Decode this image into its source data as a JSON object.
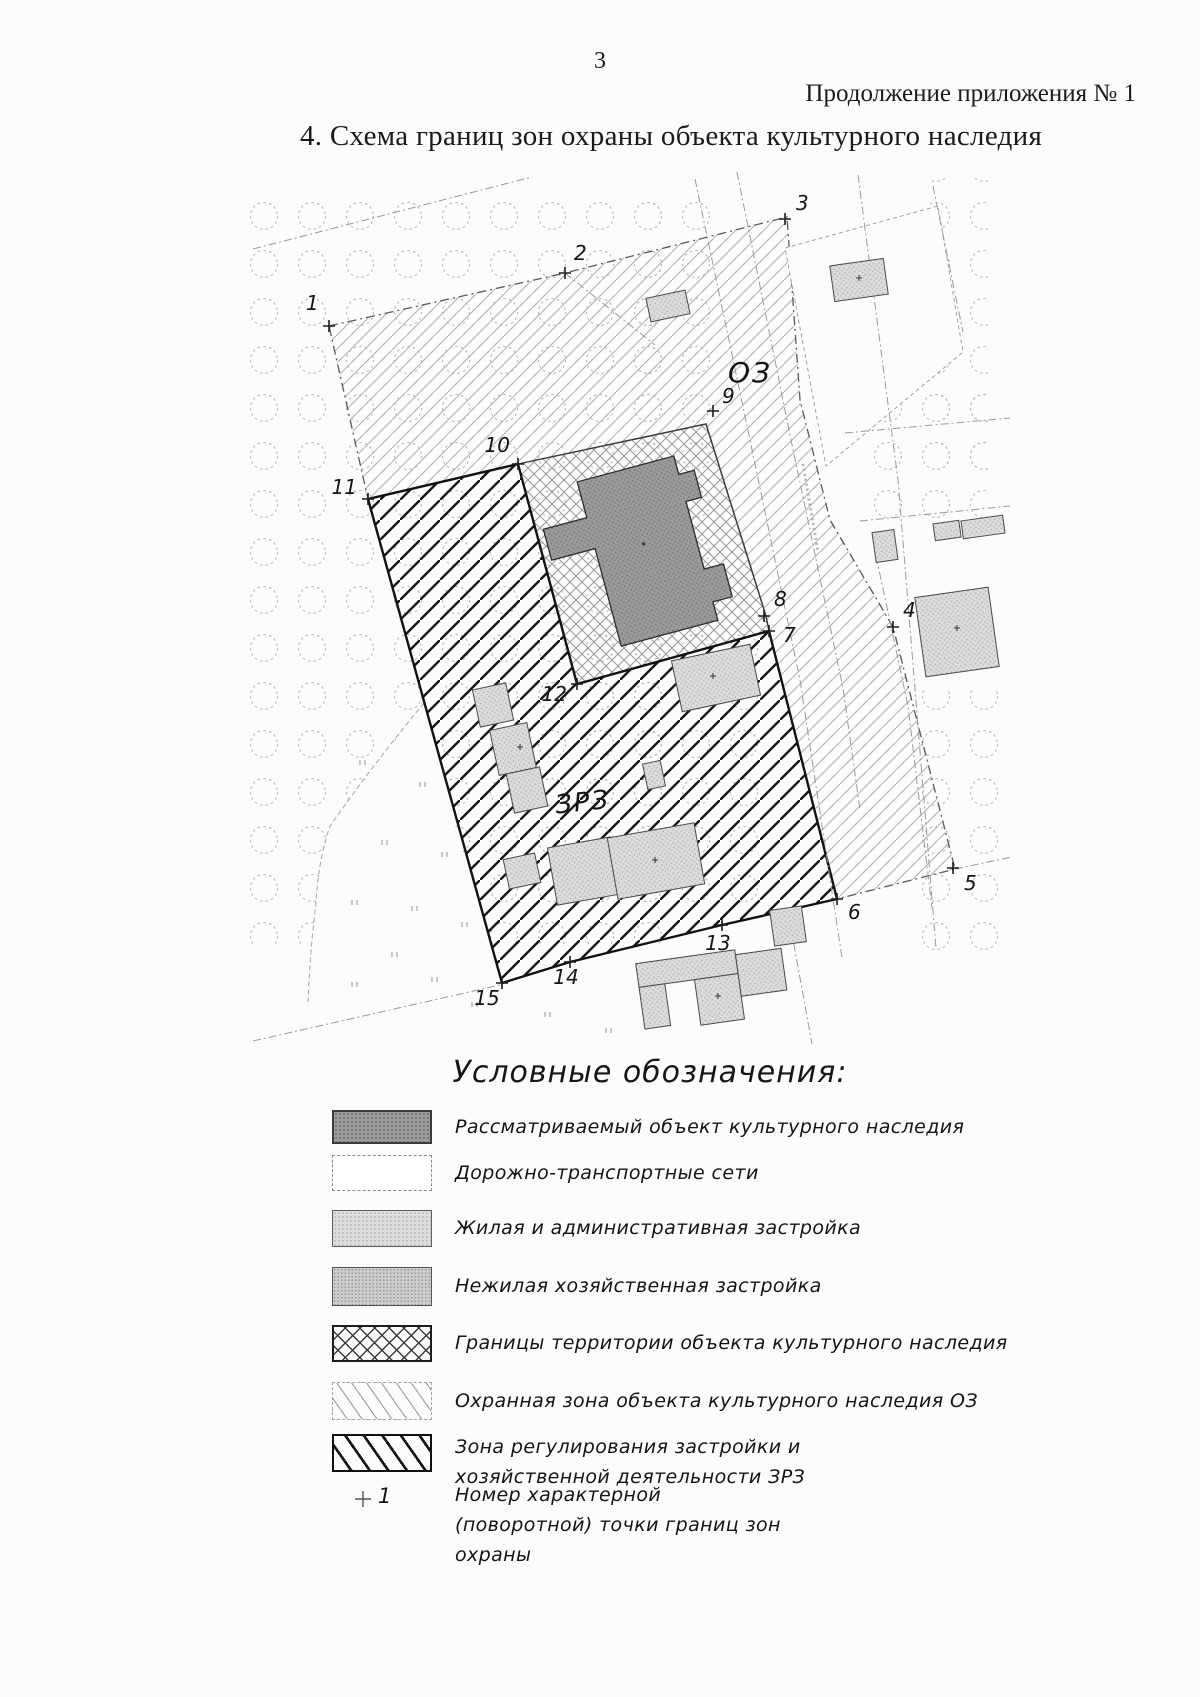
{
  "page": {
    "number": "3",
    "continuation": "Продолжение приложения № 1",
    "title": "4. Схема границ зон охраны объекта культурного наследия"
  },
  "map": {
    "oz_label": "ОЗ",
    "zrz_label": "ЗРЗ",
    "points": {
      "p1": "1",
      "p2": "2",
      "p3": "3",
      "p4": "4",
      "p5": "5",
      "p6": "6",
      "p7": "7",
      "p8": "8",
      "p9": "9",
      "p10": "10",
      "p11": "11",
      "p12": "12",
      "p13": "13",
      "p14": "14",
      "p15": "15"
    }
  },
  "legend": {
    "title": "Условные обозначения:",
    "items": [
      {
        "label": "Рассматриваемый объект культурного наследия"
      },
      {
        "label": "Дорожно-транспортные сети"
      },
      {
        "label": "Жилая и административная застройка"
      },
      {
        "label": "Нежилая хозяйственная застройка"
      },
      {
        "label": "Границы территории объекта культурного наследия"
      },
      {
        "label": "Охранная зона объекта культурного наследия ОЗ"
      },
      {
        "label": "Зона регулирования застройки и хозяйственной деятельности ЗРЗ"
      }
    ],
    "marker": {
      "number": "1",
      "label": "Номер характерной (поворотной) точки границ зон охраны"
    }
  },
  "colors": {
    "page_bg": "#fcfcfc",
    "ink": "#1a1a1a",
    "light_hatch": "#b0b0b0",
    "dark_hatch": "#161616",
    "object_fill": "#9a9a9a",
    "building_fill": "#dcdcdc"
  }
}
